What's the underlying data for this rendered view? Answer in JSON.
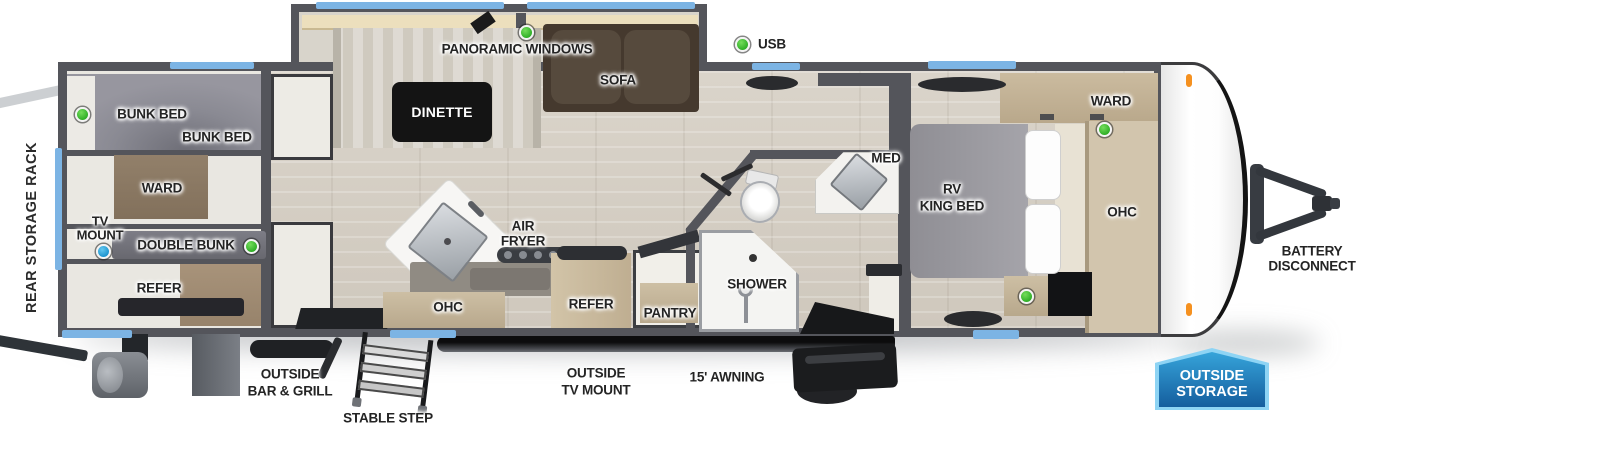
{
  "colors": {
    "wall": "#54555b",
    "window_blue": "#7cb4e4",
    "marker_green": "#3fbf35",
    "marker_blue": "#2aa8e0",
    "marker_orange": "#f59120",
    "badge_blue": "#1f78b8"
  },
  "exterior": {
    "rear_storage_rack": "REAR STORAGE RACK",
    "outside_bar_grill": [
      "OUTSIDE",
      "BAR & GRILL"
    ],
    "stable_step": "STABLE STEP",
    "outside_tv_mount": [
      "OUTSIDE",
      "TV MOUNT"
    ],
    "awning": "15' AWNING",
    "battery_disconnect": [
      "BATTERY",
      "DISCONNECT"
    ],
    "outside_storage": [
      "OUTSIDE",
      "STORAGE"
    ]
  },
  "bunk_room": {
    "bunk_bed_upper": "BUNK BED",
    "bunk_bed_lower": "BUNK BED",
    "ward": "WARD",
    "tv_mount": [
      "TV",
      "MOUNT"
    ],
    "double_bunk": "DOUBLE BUNK",
    "refer": "REFER"
  },
  "living_area": {
    "panoramic_windows": "PANORAMIC WINDOWS",
    "dinette": "DINETTE",
    "sofa": "SOFA",
    "usb": "USB"
  },
  "kitchen": {
    "air_fryer": [
      "AIR",
      "FRYER"
    ],
    "ohc": "OHC",
    "refer": "REFER",
    "pantry": "PANTRY"
  },
  "bathroom": {
    "shower": "SHOWER",
    "med": "MED"
  },
  "bedroom": {
    "rv_king_bed": [
      "RV",
      "KING BED"
    ],
    "ward": "WARD",
    "ohc": "OHC"
  }
}
